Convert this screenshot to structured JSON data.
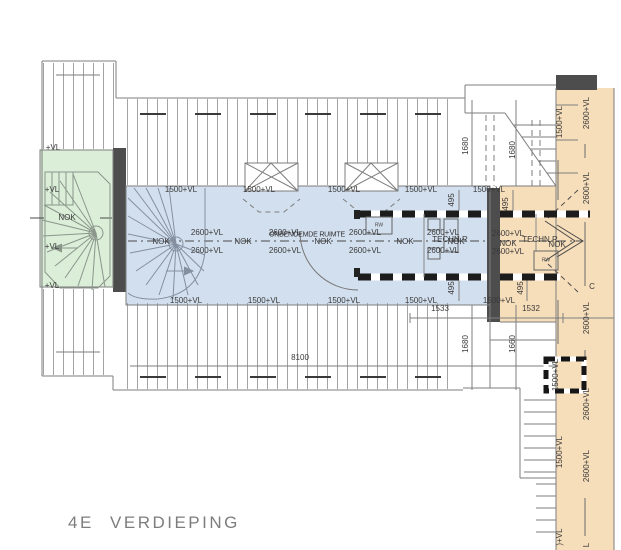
{
  "title": "4E VERDIEPING",
  "labels": {
    "vl": "+VL",
    "nok": "NOK",
    "vl1500": "1500+VL",
    "vl2600": "2600+VL",
    "vl_partial": ")+VL",
    "l_partial": "L",
    "section_c": "C",
    "room_unnamed": "ONBENOEMDE RUIMTE",
    "room_tech": "TECHN.R",
    "rw": "RW"
  },
  "dimensions": {
    "d8100": "8100",
    "d1533": "1533",
    "d1532": "1532",
    "d1680": "1680",
    "d1660": "1660",
    "d495": "495"
  },
  "colors": {
    "stairwell_green": "#daeed8",
    "corridor_blue": "#d2dfee",
    "zone_orange": "#f7debb",
    "wall_dark": "#4d4d4d",
    "line_gray": "#7e7e7e",
    "text_gray": "#3a3a3a"
  }
}
